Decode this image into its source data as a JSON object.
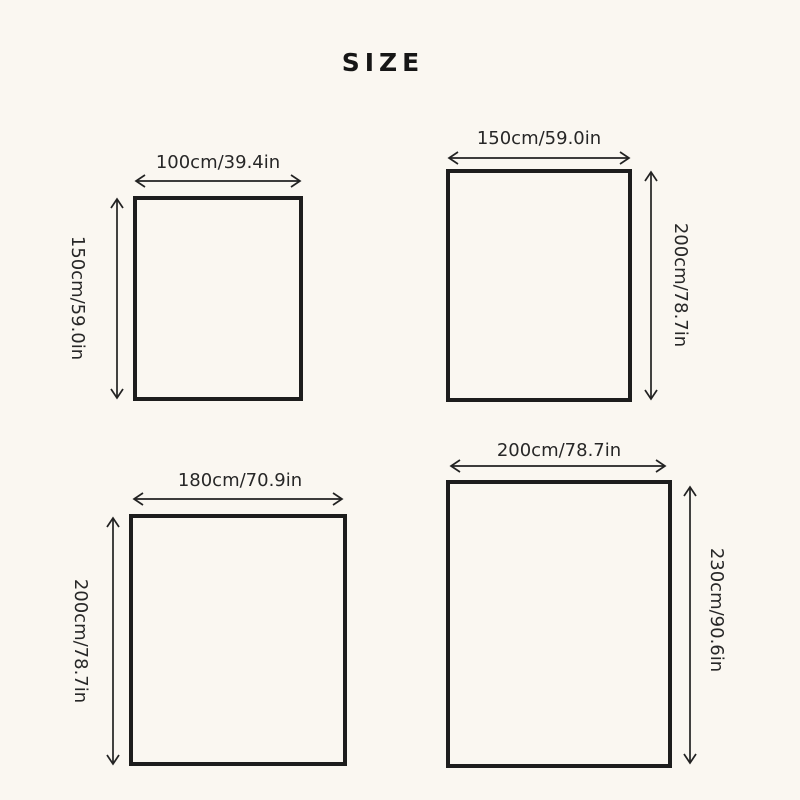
{
  "title": "SIZE",
  "colors": {
    "background": "#faf7f1",
    "line": "#222222",
    "text": "#272727"
  },
  "figures": [
    {
      "name": "size-option-1",
      "width_label": "100cm/39.4in",
      "height_label": "150cm/59.0in",
      "width": {
        "cm": 100,
        "in": 39.4
      },
      "height": {
        "cm": 150,
        "in": 59.0
      },
      "height_label_side": "left"
    },
    {
      "name": "size-option-2",
      "width_label": "150cm/59.0in",
      "height_label": "200cm/78.7in",
      "width": {
        "cm": 150,
        "in": 59.0
      },
      "height": {
        "cm": 200,
        "in": 78.7
      },
      "height_label_side": "right"
    },
    {
      "name": "size-option-3",
      "width_label": "180cm/70.9in",
      "height_label": "200cm/78.7in",
      "width": {
        "cm": 180,
        "in": 70.9
      },
      "height": {
        "cm": 200,
        "in": 78.7
      },
      "height_label_side": "left"
    },
    {
      "name": "size-option-4",
      "width_label": "200cm/78.7in",
      "height_label": "230cm/90.6in",
      "width": {
        "cm": 200,
        "in": 78.7
      },
      "height": {
        "cm": 230,
        "in": 90.6
      },
      "height_label_side": "right"
    }
  ]
}
